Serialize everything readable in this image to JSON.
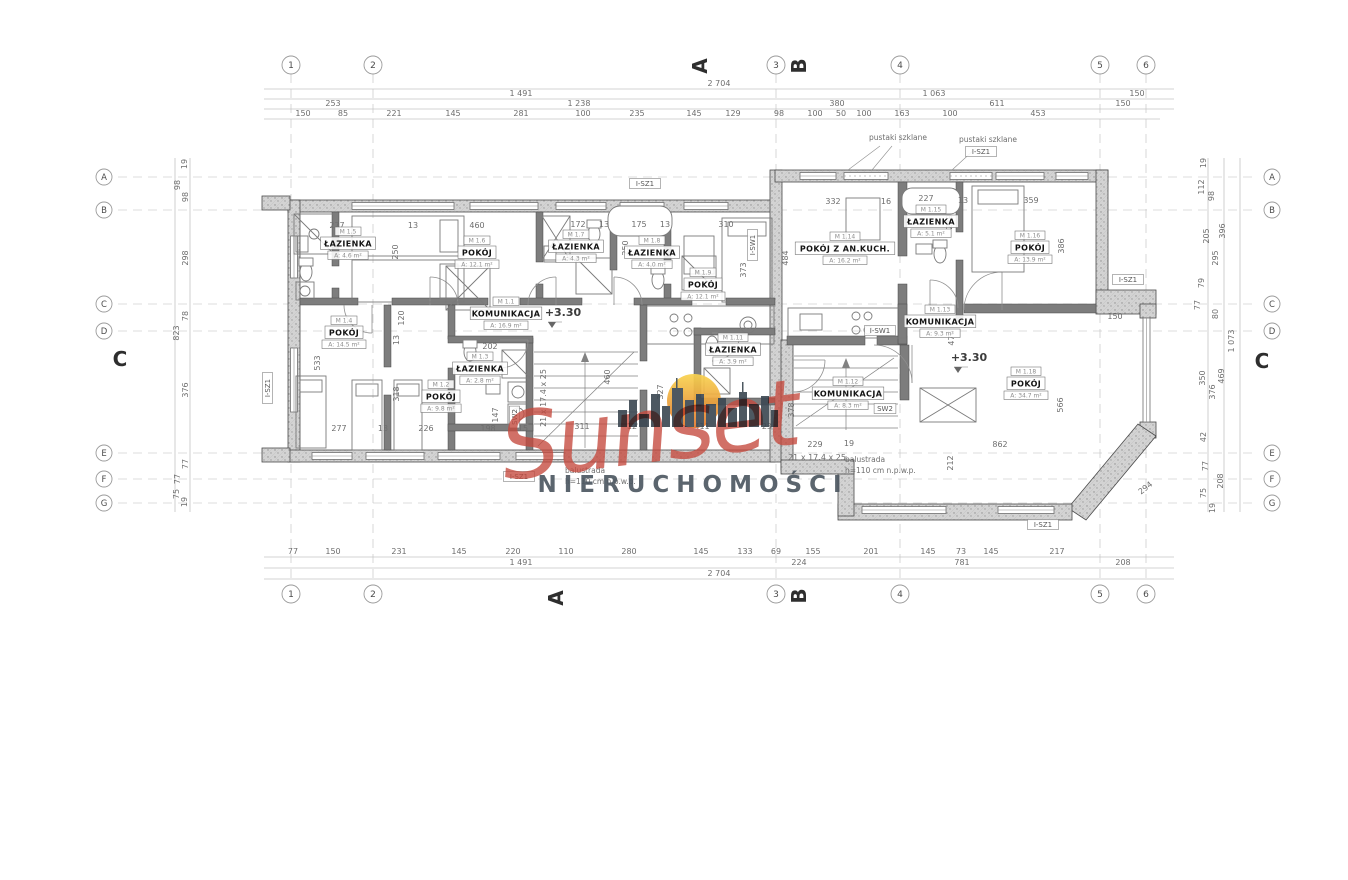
{
  "watermark": {
    "brand": "Sunset",
    "subtitle": "NIERUCHOMOŚCI",
    "script_color": "#c5493d",
    "skyline_color": "#3e4a54",
    "subtitle_color": "#4e5862",
    "sun_top": "#f9d34f",
    "sun_bottom": "#e0772e"
  },
  "grid": {
    "columns": [
      {
        "label": "1",
        "x": 291
      },
      {
        "label": "2",
        "x": 373
      },
      {
        "label": "3",
        "x": 776
      },
      {
        "label": "4",
        "x": 900
      },
      {
        "label": "5",
        "x": 1100
      },
      {
        "label": "6",
        "x": 1146
      }
    ],
    "rows": [
      {
        "label": "A",
        "y": 177
      },
      {
        "label": "B",
        "y": 210
      },
      {
        "label": "C",
        "y": 304
      },
      {
        "label": "D",
        "y": 331
      },
      {
        "label": "E",
        "y": 453
      },
      {
        "label": "F",
        "y": 479
      },
      {
        "label": "G",
        "y": 503
      }
    ]
  },
  "section_markers": [
    {
      "label": "A",
      "x": 707,
      "y": 66,
      "r": -90
    },
    {
      "label": "B",
      "x": 806,
      "y": 66,
      "r": -90
    },
    {
      "label": "A",
      "x": 563,
      "y": 598,
      "r": -90
    },
    {
      "label": "B",
      "x": 806,
      "y": 596,
      "r": -90
    },
    {
      "label": "C",
      "x": 120,
      "y": 366,
      "r": 0
    },
    {
      "label": "C",
      "x": 1262,
      "y": 368,
      "r": 0
    }
  ],
  "rooms": [
    {
      "id": "M 1.5",
      "name": "ŁAZIENKA",
      "area": "A: 4.6 m²",
      "x": 348,
      "y": 247
    },
    {
      "id": "M 1.6",
      "name": "POKÓJ",
      "area": "A: 12.1 m²",
      "x": 477,
      "y": 256
    },
    {
      "id": "M 1.7",
      "name": "ŁAZIENKA",
      "area": "A: 4.3 m²",
      "x": 576,
      "y": 250
    },
    {
      "id": "M 1.8",
      "name": "ŁAZIENKA",
      "area": "A: 4.0 m²",
      "x": 652,
      "y": 256
    },
    {
      "id": "M 1.9",
      "name": "POKÓJ",
      "area": "A: 12.1 m²",
      "x": 703,
      "y": 288
    },
    {
      "id": "M 1.1",
      "name": "KOMUNIKACJA",
      "area": "A: 16.9 m²",
      "x": 506,
      "y": 317
    },
    {
      "id": "M 1.4",
      "name": "POKÓJ",
      "area": "A: 14.5 m²",
      "x": 344,
      "y": 336
    },
    {
      "id": "M 1.2",
      "name": "POKÓJ",
      "area": "A: 9.8 m²",
      "x": 441,
      "y": 400
    },
    {
      "id": "M 1.3",
      "name": "ŁAZIENKA",
      "area": "A: 2.8 m²",
      "x": 480,
      "y": 372
    },
    {
      "id": "M 1.11",
      "name": "ŁAZIENKA",
      "area": "A: 3.9 m²",
      "x": 733,
      "y": 353
    },
    {
      "id": "M 1.14",
      "name": "POKÓJ Z AN.KUCH.",
      "area": "A: 16.2 m²",
      "x": 845,
      "y": 252
    },
    {
      "id": "M 1.15",
      "name": "ŁAZIENKA",
      "area": "A: 5.1 m²",
      "x": 931,
      "y": 225
    },
    {
      "id": "M 1.16",
      "name": "POKÓJ",
      "area": "A: 13.9 m²",
      "x": 1030,
      "y": 251
    },
    {
      "id": "M 1.13",
      "name": "KOMUNIKACJA",
      "area": "A: 9.3 m²",
      "x": 940,
      "y": 325
    },
    {
      "id": "M 1.12",
      "name": "KOMUNIKACJA",
      "area": "A: 8.3 m²",
      "x": 848,
      "y": 397
    },
    {
      "id": "M 1.18",
      "name": "POKÓJ",
      "area": "A: 34.7 m²",
      "x": 1026,
      "y": 387
    }
  ],
  "dims": [
    {
      "t": "2 704",
      "x": 719,
      "y": 86
    },
    {
      "t": "1 491",
      "x": 521,
      "y": 96
    },
    {
      "t": "1 063",
      "x": 934,
      "y": 96
    },
    {
      "t": "150",
      "x": 1137,
      "y": 96
    },
    {
      "t": "253",
      "x": 333,
      "y": 106
    },
    {
      "t": "1 238",
      "x": 579,
      "y": 106
    },
    {
      "t": "380",
      "x": 837,
      "y": 106
    },
    {
      "t": "611",
      "x": 997,
      "y": 106
    },
    {
      "t": "150",
      "x": 1123,
      "y": 106
    },
    {
      "t": "150",
      "x": 303,
      "y": 116
    },
    {
      "t": "85",
      "x": 343,
      "y": 116
    },
    {
      "t": "221",
      "x": 394,
      "y": 116
    },
    {
      "t": "145",
      "x": 453,
      "y": 116
    },
    {
      "t": "281",
      "x": 521,
      "y": 116
    },
    {
      "t": "100",
      "x": 583,
      "y": 116
    },
    {
      "t": "235",
      "x": 637,
      "y": 116
    },
    {
      "t": "145",
      "x": 694,
      "y": 116
    },
    {
      "t": "129",
      "x": 733,
      "y": 116
    },
    {
      "t": "98",
      "x": 779,
      "y": 116
    },
    {
      "t": "100",
      "x": 815,
      "y": 116
    },
    {
      "t": "50",
      "x": 841,
      "y": 116
    },
    {
      "t": "100",
      "x": 864,
      "y": 116
    },
    {
      "t": "163",
      "x": 902,
      "y": 116
    },
    {
      "t": "100",
      "x": 950,
      "y": 116
    },
    {
      "t": "453",
      "x": 1038,
      "y": 116
    },
    {
      "t": "77",
      "x": 293,
      "y": 554
    },
    {
      "t": "150",
      "x": 333,
      "y": 554
    },
    {
      "t": "231",
      "x": 399,
      "y": 554
    },
    {
      "t": "145",
      "x": 459,
      "y": 554
    },
    {
      "t": "220",
      "x": 513,
      "y": 554
    },
    {
      "t": "110",
      "x": 566,
      "y": 554
    },
    {
      "t": "280",
      "x": 629,
      "y": 554
    },
    {
      "t": "145",
      "x": 701,
      "y": 554
    },
    {
      "t": "133",
      "x": 745,
      "y": 554
    },
    {
      "t": "69",
      "x": 776,
      "y": 554
    },
    {
      "t": "155",
      "x": 813,
      "y": 554
    },
    {
      "t": "201",
      "x": 871,
      "y": 554
    },
    {
      "t": "145",
      "x": 928,
      "y": 554
    },
    {
      "t": "73",
      "x": 961,
      "y": 554
    },
    {
      "t": "145",
      "x": 991,
      "y": 554
    },
    {
      "t": "217",
      "x": 1057,
      "y": 554
    },
    {
      "t": "1 491",
      "x": 521,
      "y": 565
    },
    {
      "t": "224",
      "x": 799,
      "y": 565
    },
    {
      "t": "781",
      "x": 962,
      "y": 565
    },
    {
      "t": "208",
      "x": 1123,
      "y": 565
    },
    {
      "t": "2 704",
      "x": 719,
      "y": 576
    },
    {
      "t": "19",
      "x": 187,
      "y": 164,
      "r": -90
    },
    {
      "t": "98",
      "x": 180,
      "y": 185,
      "r": -90
    },
    {
      "t": "98",
      "x": 188,
      "y": 197,
      "r": -90
    },
    {
      "t": "298",
      "x": 188,
      "y": 258,
      "r": -90
    },
    {
      "t": "78",
      "x": 188,
      "y": 316,
      "r": -90
    },
    {
      "t": "823",
      "x": 179,
      "y": 333,
      "r": -90
    },
    {
      "t": "376",
      "x": 188,
      "y": 390,
      "r": -90
    },
    {
      "t": "77",
      "x": 188,
      "y": 464,
      "r": -90
    },
    {
      "t": "77",
      "x": 180,
      "y": 479,
      "r": -90
    },
    {
      "t": "75",
      "x": 179,
      "y": 494,
      "r": -90
    },
    {
      "t": "19",
      "x": 187,
      "y": 502,
      "r": -90
    },
    {
      "t": "19",
      "x": 1206,
      "y": 163,
      "r": -90
    },
    {
      "t": "112",
      "x": 1204,
      "y": 187,
      "r": -90
    },
    {
      "t": "98",
      "x": 1214,
      "y": 196,
      "r": -90
    },
    {
      "t": "205",
      "x": 1209,
      "y": 236,
      "r": -90
    },
    {
      "t": "396",
      "x": 1225,
      "y": 231,
      "r": -90
    },
    {
      "t": "295",
      "x": 1218,
      "y": 258,
      "r": -90
    },
    {
      "t": "79",
      "x": 1204,
      "y": 283,
      "r": -90
    },
    {
      "t": "77",
      "x": 1200,
      "y": 305,
      "r": -90
    },
    {
      "t": "80",
      "x": 1218,
      "y": 314,
      "r": -90
    },
    {
      "t": "1 073",
      "x": 1234,
      "y": 341,
      "r": -90
    },
    {
      "t": "350",
      "x": 1205,
      "y": 378,
      "r": -90
    },
    {
      "t": "469",
      "x": 1224,
      "y": 376,
      "r": -90
    },
    {
      "t": "376",
      "x": 1215,
      "y": 392,
      "r": -90
    },
    {
      "t": "42",
      "x": 1206,
      "y": 437,
      "r": -90
    },
    {
      "t": "77",
      "x": 1208,
      "y": 466,
      "r": -90
    },
    {
      "t": "208",
      "x": 1223,
      "y": 481,
      "r": -90
    },
    {
      "t": "75",
      "x": 1206,
      "y": 493,
      "r": -90
    },
    {
      "t": "19",
      "x": 1215,
      "y": 508,
      "r": -90
    },
    {
      "t": "294",
      "x": 1147,
      "y": 490,
      "r": -38
    },
    {
      "t": "277",
      "x": 337,
      "y": 228
    },
    {
      "t": "13",
      "x": 413,
      "y": 228
    },
    {
      "t": "460",
      "x": 477,
      "y": 228
    },
    {
      "t": "172",
      "x": 578,
      "y": 227
    },
    {
      "t": "13",
      "x": 604,
      "y": 227
    },
    {
      "t": "175",
      "x": 639,
      "y": 227
    },
    {
      "t": "13",
      "x": 665,
      "y": 227
    },
    {
      "t": "310",
      "x": 726,
      "y": 227
    },
    {
      "t": "332",
      "x": 833,
      "y": 204
    },
    {
      "t": "16",
      "x": 886,
      "y": 204
    },
    {
      "t": "227",
      "x": 926,
      "y": 201
    },
    {
      "t": "13",
      "x": 963,
      "y": 203
    },
    {
      "t": "359",
      "x": 1031,
      "y": 203
    },
    {
      "t": "250",
      "x": 398,
      "y": 252,
      "r": -90
    },
    {
      "t": "120",
      "x": 404,
      "y": 318,
      "r": -90
    },
    {
      "t": "13",
      "x": 399,
      "y": 340,
      "r": -90
    },
    {
      "t": "250",
      "x": 628,
      "y": 248,
      "r": -90
    },
    {
      "t": "373",
      "x": 746,
      "y": 270,
      "r": -90
    },
    {
      "t": "484",
      "x": 788,
      "y": 258,
      "r": -90
    },
    {
      "t": "249",
      "x": 952,
      "y": 222,
      "r": -90
    },
    {
      "t": "386",
      "x": 1064,
      "y": 246,
      "r": -90
    },
    {
      "t": "533",
      "x": 320,
      "y": 363,
      "r": -90
    },
    {
      "t": "318",
      "x": 399,
      "y": 394,
      "r": -90
    },
    {
      "t": "147",
      "x": 498,
      "y": 415,
      "r": -90
    },
    {
      "t": "460",
      "x": 610,
      "y": 377,
      "r": -90
    },
    {
      "t": "327",
      "x": 663,
      "y": 392,
      "r": -90
    },
    {
      "t": "378",
      "x": 794,
      "y": 410,
      "r": -90
    },
    {
      "t": "476",
      "x": 954,
      "y": 338,
      "r": -90
    },
    {
      "t": "566",
      "x": 1063,
      "y": 405,
      "r": -90
    },
    {
      "t": "212",
      "x": 953,
      "y": 463,
      "r": -90
    },
    {
      "t": "202",
      "x": 490,
      "y": 349
    },
    {
      "t": "150",
      "x": 1115,
      "y": 319
    },
    {
      "t": "862",
      "x": 1000,
      "y": 447
    },
    {
      "t": "229",
      "x": 815,
      "y": 447
    },
    {
      "t": "19",
      "x": 849,
      "y": 446
    },
    {
      "t": "311",
      "x": 582,
      "y": 429
    },
    {
      "t": "12",
      "x": 632,
      "y": 429
    },
    {
      "t": "411",
      "x": 702,
      "y": 429
    },
    {
      "t": "23",
      "x": 767,
      "y": 429
    },
    {
      "t": "277",
      "x": 339,
      "y": 431
    },
    {
      "t": "13",
      "x": 383,
      "y": 431
    },
    {
      "t": "226",
      "x": 426,
      "y": 431
    },
    {
      "t": "198",
      "x": 488,
      "y": 431
    },
    {
      "t": "15",
      "x": 523,
      "y": 431
    },
    {
      "t": "21 x 17.4 x 25",
      "x": 546,
      "y": 398,
      "r": -90
    },
    {
      "t": "21 x 17.4 x 25",
      "x": 817,
      "y": 460
    }
  ],
  "annotations": [
    {
      "t": "pustaki szklane",
      "x": 898,
      "y": 140
    },
    {
      "t": "pustaki szklane",
      "x": 988,
      "y": 142
    },
    {
      "t": "I-SZ1",
      "x": 645,
      "y": 186,
      "box": 1
    },
    {
      "t": "I-SZ1",
      "x": 981,
      "y": 154,
      "box": 1
    },
    {
      "t": "I-SZ1",
      "x": 1128,
      "y": 282,
      "box": 1
    },
    {
      "t": "I-SZ1",
      "x": 519,
      "y": 479,
      "box": 1
    },
    {
      "t": "I-SZ1",
      "x": 1043,
      "y": 527,
      "box": 1
    },
    {
      "t": "I-SZ1",
      "x": 270,
      "y": 388,
      "box": 1,
      "r": -90
    },
    {
      "t": "I-SW1",
      "x": 880,
      "y": 333,
      "box": 1
    },
    {
      "t": "I-SW1",
      "x": 755,
      "y": 245,
      "box": 1,
      "r": -90
    },
    {
      "t": "SW2",
      "x": 885,
      "y": 411,
      "box": 1
    },
    {
      "t": "SW2",
      "x": 517,
      "y": 417,
      "box": 1,
      "r": -90
    },
    {
      "t": "+3.30",
      "x": 563,
      "y": 316,
      "fs": 11
    },
    {
      "t": "+3.30",
      "x": 969,
      "y": 361,
      "fs": 11
    },
    {
      "t": "balustrada",
      "x": 565,
      "y": 473,
      "anchor": "start"
    },
    {
      "t": "h=110 cm n.p.w.p.",
      "x": 565,
      "y": 484,
      "anchor": "start"
    },
    {
      "t": "balustrada",
      "x": 845,
      "y": 462,
      "anchor": "start"
    },
    {
      "t": "h=110 cm n.p.w.p.",
      "x": 845,
      "y": 473,
      "anchor": "start"
    }
  ]
}
